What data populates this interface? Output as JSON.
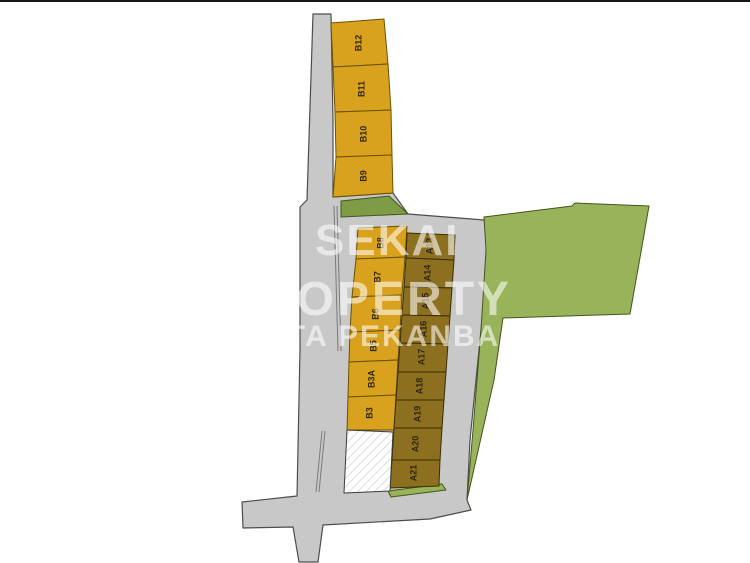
{
  "title": "housing site plan (kavling map)",
  "watermark": {
    "line1": "SEKAI",
    "line2": "PROPERTY",
    "line3": "KOTA PEKANBARU"
  },
  "plots": {
    "row_top": [
      {
        "label": "B12"
      },
      {
        "label": "B11"
      },
      {
        "label": "B10"
      },
      {
        "label": "B9"
      }
    ],
    "col_left": [
      {
        "label": "B8"
      },
      {
        "label": "B7"
      },
      {
        "label": "B6"
      },
      {
        "label": "B5"
      },
      {
        "label": "B3A"
      },
      {
        "label": "B3"
      }
    ],
    "col_right": [
      {
        "label": "A13"
      },
      {
        "label": "A14"
      },
      {
        "label": "A15"
      },
      {
        "label": "A16"
      },
      {
        "label": "A17"
      },
      {
        "label": "A18"
      },
      {
        "label": "A19"
      },
      {
        "label": "A20"
      },
      {
        "label": "A21"
      }
    ],
    "unlabeled_white_plot": {
      "label": ""
    }
  },
  "colors": {
    "road": "#c8c8c8",
    "road_outline": "#4d4d4d",
    "plot_gold": "#d8a11e",
    "plot_gold_outline": "#6b5200",
    "plot_dark_olive": "#8d6f20",
    "plot_dark_outline": "#3a2e00",
    "green_field": "#98b35a",
    "green_dark_wedge": "#7d9c45",
    "green_outline": "#44551f",
    "background": "#ffffff",
    "watermark_white": "#ffffff",
    "label_text": "#33280a"
  }
}
